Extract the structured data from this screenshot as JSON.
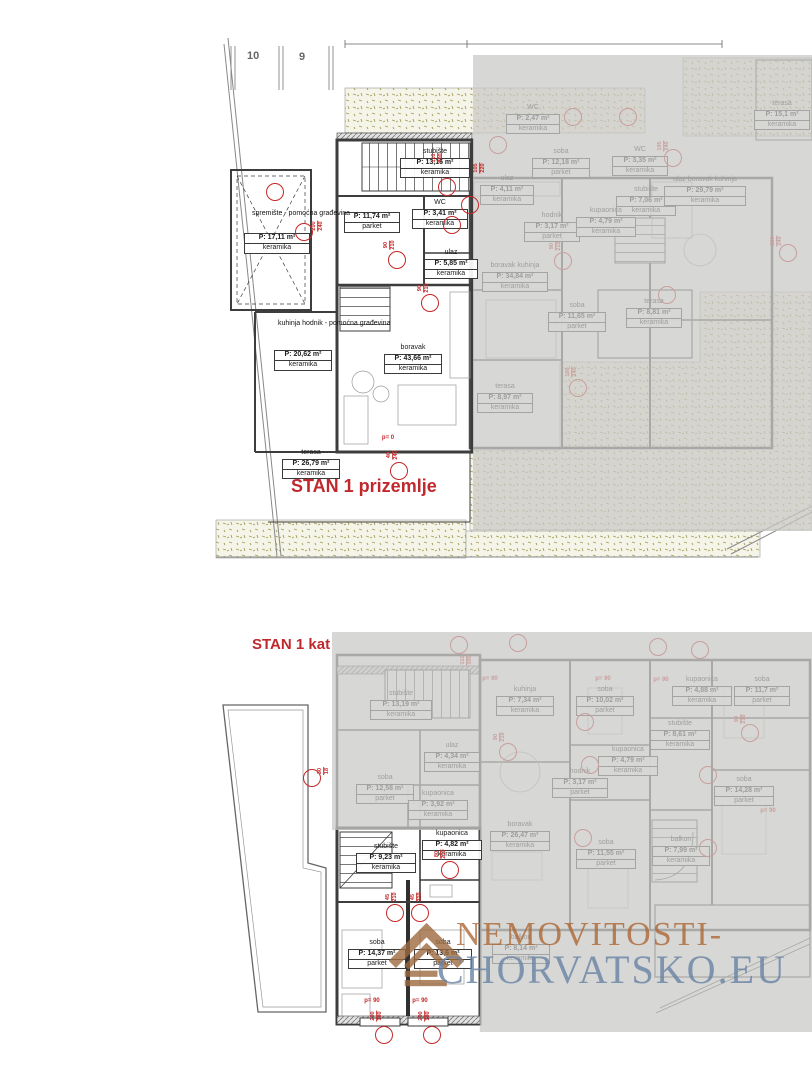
{
  "plot_numbers": [
    "10",
    "9"
  ],
  "watermark": {
    "line1": "NEMOVITOSTI-",
    "line2": "CHORVATSKO.EU"
  },
  "colors": {
    "annotation_red": "#c62828",
    "title_red": "#c0282e",
    "overlay_gray": "#c9c9c7",
    "wall_dark": "#3d3d3d",
    "speckle_olive": "#a39d55",
    "watermark_brown": "#9c6a3f",
    "watermark_blue": "#6a84a5"
  },
  "plan1": {
    "title": "STAN 1 prizemlje",
    "free_texts": [
      {
        "text": "spremište - pomoćna građevina",
        "x": 252,
        "y": 210
      },
      {
        "text": "kuhinja hodnik - pomoćna građevina",
        "x": 278,
        "y": 320
      }
    ],
    "rooms_active": [
      {
        "a": "P: 17,11 m²",
        "f": "keramika",
        "x": 244,
        "y": 233,
        "w": 66
      },
      {
        "n": "stubište",
        "a": "P: 13,16 m²",
        "f": "keramika",
        "x": 400,
        "y": 148,
        "w": 70
      },
      {
        "n": "WC",
        "a": "P: 3,41 m²",
        "f": "keramika",
        "x": 412,
        "y": 199,
        "w": 56
      },
      {
        "a": "P: 11,74 m²",
        "f": "parket",
        "x": 344,
        "y": 212,
        "w": 56
      },
      {
        "n": "ulaz",
        "a": "P: 5,85 m²",
        "f": "keramika",
        "x": 424,
        "y": 249,
        "w": 54
      },
      {
        "a": "P: 20,62 m²",
        "f": "keramika",
        "x": 274,
        "y": 350,
        "w": 58
      },
      {
        "n": "boravak",
        "a": "P: 43,66 m²",
        "f": "keramika",
        "x": 384,
        "y": 344,
        "w": 58
      },
      {
        "n": "terasa",
        "a": "P: 26,79 m²",
        "f": "keramika",
        "x": 282,
        "y": 449,
        "w": 58
      }
    ],
    "rooms_inactive": [
      {
        "n": "WC",
        "a": "P: 2,47 m²",
        "f": "keramika",
        "x": 506,
        "y": 104,
        "w": 54
      },
      {
        "n": "soba",
        "a": "P: 12,18 m²",
        "f": "parket",
        "x": 532,
        "y": 148,
        "w": 58
      },
      {
        "n": "ulaz",
        "a": "P: 4,11 m²",
        "f": "keramika",
        "x": 480,
        "y": 175,
        "w": 54
      },
      {
        "n": "WC",
        "a": "P: 3,35 m²",
        "f": "keramika",
        "x": 612,
        "y": 146,
        "w": 56
      },
      {
        "n": "stubište",
        "a": "P: 7,06 m²",
        "f": "keramika",
        "x": 616,
        "y": 186,
        "w": 60
      },
      {
        "n": "hodnik",
        "a": "P: 3,17 m²",
        "f": "parket",
        "x": 524,
        "y": 212,
        "w": 56
      },
      {
        "n": "kupaonica",
        "a": "P: 4,79 m²",
        "f": "keramika",
        "x": 576,
        "y": 207,
        "w": 60
      },
      {
        "n": "ulaz boravak kuhinja",
        "a": "P: 29,79 m²",
        "f": "keramika",
        "x": 664,
        "y": 176,
        "w": 82
      },
      {
        "n": "boravak kuhinja",
        "a": "P: 34,84 m²",
        "f": "keramika",
        "x": 482,
        "y": 262,
        "w": 66
      },
      {
        "n": "soba",
        "a": "P: 11,65 m²",
        "f": "parket",
        "x": 548,
        "y": 302,
        "w": 58
      },
      {
        "n": "terasa",
        "a": "P: 8,81 m²",
        "f": "keramika",
        "x": 626,
        "y": 298,
        "w": 56
      },
      {
        "n": "terasa",
        "a": "P: 8,97 m²",
        "f": "keramika",
        "x": 477,
        "y": 383,
        "w": 56
      },
      {
        "n": "terasa",
        "a": "P: 15,1 m²",
        "f": "keramika",
        "x": 754,
        "y": 100,
        "w": 56
      }
    ],
    "annotations_active": [
      {
        "t": "dim",
        "x": 438,
        "y": 158,
        "a": "110",
        "b": "300"
      },
      {
        "t": "circle",
        "x": 447,
        "y": 187
      },
      {
        "t": "dim",
        "x": 480,
        "y": 168,
        "a": "105",
        "b": "220"
      },
      {
        "t": "circle",
        "x": 470,
        "y": 205
      },
      {
        "t": "circle",
        "x": 452,
        "y": 225
      },
      {
        "t": "dim",
        "x": 390,
        "y": 245,
        "a": "90",
        "b": "210"
      },
      {
        "t": "circle",
        "x": 397,
        "y": 260
      },
      {
        "t": "dim",
        "x": 318,
        "y": 226,
        "a": "200",
        "b": "240"
      },
      {
        "t": "circle",
        "x": 304,
        "y": 232
      },
      {
        "t": "circle",
        "x": 275,
        "y": 192
      },
      {
        "t": "dim",
        "x": 424,
        "y": 288,
        "a": "90",
        "b": "210"
      },
      {
        "t": "circle",
        "x": 430,
        "y": 303
      },
      {
        "t": "ptext",
        "x": 388,
        "y": 438,
        "label": "p= 0"
      },
      {
        "t": "dim",
        "x": 393,
        "y": 455,
        "a": "40",
        "b": "240"
      },
      {
        "t": "circle",
        "x": 399,
        "y": 471
      }
    ],
    "annotations_inactive": [
      {
        "t": "circle",
        "x": 498,
        "y": 145
      },
      {
        "t": "circle",
        "x": 573,
        "y": 117
      },
      {
        "t": "circle",
        "x": 628,
        "y": 117
      },
      {
        "t": "dim",
        "x": 556,
        "y": 246,
        "a": "90",
        "b": "210"
      },
      {
        "t": "circle",
        "x": 563,
        "y": 261
      },
      {
        "t": "dim",
        "x": 664,
        "y": 146,
        "a": "105",
        "b": "240"
      },
      {
        "t": "circle",
        "x": 673,
        "y": 158
      },
      {
        "t": "dim",
        "x": 777,
        "y": 241,
        "a": "200",
        "b": "240"
      },
      {
        "t": "circle",
        "x": 788,
        "y": 253
      },
      {
        "t": "circle",
        "x": 667,
        "y": 295
      },
      {
        "t": "dim",
        "x": 572,
        "y": 372,
        "a": "100",
        "b": "240"
      },
      {
        "t": "circle",
        "x": 578,
        "y": 388
      }
    ]
  },
  "plan2": {
    "title": "STAN 1 kat",
    "rooms_active": [
      {
        "n": "stubište",
        "a": "P: 9,23 m²",
        "f": "keramika",
        "x": 356,
        "y": 843,
        "w": 60
      },
      {
        "n": "kupaonica",
        "a": "P: 4,82 m²",
        "f": "keramika",
        "x": 422,
        "y": 830,
        "w": 60
      },
      {
        "n": "soba",
        "a": "P: 14,37 m²",
        "f": "parket",
        "x": 348,
        "y": 939,
        "w": 58
      },
      {
        "n": "soba",
        "a": "P: 13,6 m²",
        "f": "parket",
        "x": 414,
        "y": 939,
        "w": 58
      }
    ],
    "rooms_inactive": [
      {
        "n": "stubište",
        "a": "P: 13,19 m²",
        "f": "keramika",
        "x": 370,
        "y": 690,
        "w": 62
      },
      {
        "n": "ulaz",
        "a": "P: 4,34 m²",
        "f": "keramika",
        "x": 424,
        "y": 742,
        "w": 56
      },
      {
        "n": "soba",
        "a": "P: 12,58 m²",
        "f": "parket",
        "x": 356,
        "y": 774,
        "w": 58
      },
      {
        "n": "kupaonica",
        "a": "P: 3,92 m²",
        "f": "keramika",
        "x": 408,
        "y": 790,
        "w": 60
      },
      {
        "n": "kuhinja",
        "a": "P: 7,34 m²",
        "f": "keramika",
        "x": 496,
        "y": 686,
        "w": 58
      },
      {
        "n": "soba",
        "a": "P: 10,02 m²",
        "f": "parket",
        "x": 576,
        "y": 686,
        "w": 58
      },
      {
        "n": "kupaonica",
        "a": "P: 4,79 m²",
        "f": "keramika",
        "x": 598,
        "y": 746,
        "w": 60
      },
      {
        "n": "hodnik",
        "a": "P: 3,17 m²",
        "f": "parket",
        "x": 552,
        "y": 768,
        "w": 56
      },
      {
        "n": "kupaonica",
        "a": "P: 4,88 m²",
        "f": "keramika",
        "x": 672,
        "y": 676,
        "w": 60
      },
      {
        "n": "soba",
        "a": "P: 11,7 m²",
        "f": "parket",
        "x": 734,
        "y": 676,
        "w": 56
      },
      {
        "n": "stubište",
        "a": "P: 8,61 m²",
        "f": "keramika",
        "x": 650,
        "y": 720,
        "w": 60
      },
      {
        "n": "soba",
        "a": "P: 14,28 m²",
        "f": "parket",
        "x": 714,
        "y": 776,
        "w": 60
      },
      {
        "n": "boravak",
        "a": "P: 26,47 m²",
        "f": "keramika",
        "x": 490,
        "y": 821,
        "w": 60
      },
      {
        "n": "soba",
        "a": "P: 11,55 m²",
        "f": "parket",
        "x": 576,
        "y": 839,
        "w": 60
      },
      {
        "n": "balkon",
        "a": "P: 7,99 m²",
        "f": "keramika",
        "x": 652,
        "y": 836,
        "w": 58
      },
      {
        "n": "balkon",
        "a": "P: 8,14 m²",
        "f": "keramika",
        "x": 492,
        "y": 934,
        "w": 58
      }
    ],
    "annotations_active": [
      {
        "t": "circle",
        "x": 312,
        "y": 778
      },
      {
        "t": "dim",
        "x": 324,
        "y": 771,
        "a": "30",
        "b": "18"
      },
      {
        "t": "circle",
        "x": 450,
        "y": 870
      },
      {
        "t": "dim",
        "x": 441,
        "y": 854,
        "a": "80",
        "b": "210"
      },
      {
        "t": "dim",
        "x": 392,
        "y": 897,
        "a": "45",
        "b": "210"
      },
      {
        "t": "circle",
        "x": 395,
        "y": 913
      },
      {
        "t": "dim",
        "x": 417,
        "y": 897,
        "a": "45",
        "b": "210"
      },
      {
        "t": "circle",
        "x": 420,
        "y": 913
      },
      {
        "t": "ptext",
        "x": 372,
        "y": 1001,
        "label": "p= 90"
      },
      {
        "t": "dim",
        "x": 377,
        "y": 1016,
        "a": "200",
        "b": "180"
      },
      {
        "t": "circle",
        "x": 384,
        "y": 1035
      },
      {
        "t": "ptext",
        "x": 420,
        "y": 1001,
        "label": "p= 90"
      },
      {
        "t": "dim",
        "x": 425,
        "y": 1016,
        "a": "200",
        "b": "180"
      },
      {
        "t": "circle",
        "x": 432,
        "y": 1035
      }
    ],
    "annotations_inactive": [
      {
        "t": "circle",
        "x": 459,
        "y": 645
      },
      {
        "t": "dim",
        "x": 467,
        "y": 660,
        "a": "110",
        "b": "300"
      },
      {
        "t": "circle",
        "x": 518,
        "y": 643
      },
      {
        "t": "circle",
        "x": 658,
        "y": 647
      },
      {
        "t": "circle",
        "x": 700,
        "y": 650
      },
      {
        "t": "ptext",
        "x": 490,
        "y": 679,
        "label": "p= 90"
      },
      {
        "t": "ptext",
        "x": 603,
        "y": 679,
        "label": "p= 90"
      },
      {
        "t": "ptext",
        "x": 661,
        "y": 680,
        "label": "p= 90"
      },
      {
        "t": "dim",
        "x": 500,
        "y": 737,
        "a": "90",
        "b": "210"
      },
      {
        "t": "circle",
        "x": 508,
        "y": 752
      },
      {
        "t": "circle",
        "x": 585,
        "y": 722
      },
      {
        "t": "circle",
        "x": 590,
        "y": 765
      },
      {
        "t": "dim",
        "x": 741,
        "y": 719,
        "a": "90",
        "b": "210"
      },
      {
        "t": "circle",
        "x": 750,
        "y": 733
      },
      {
        "t": "circle",
        "x": 708,
        "y": 775
      },
      {
        "t": "ptext",
        "x": 768,
        "y": 811,
        "label": "p= 90"
      },
      {
        "t": "circle",
        "x": 583,
        "y": 838
      },
      {
        "t": "circle",
        "x": 708,
        "y": 848
      }
    ]
  }
}
